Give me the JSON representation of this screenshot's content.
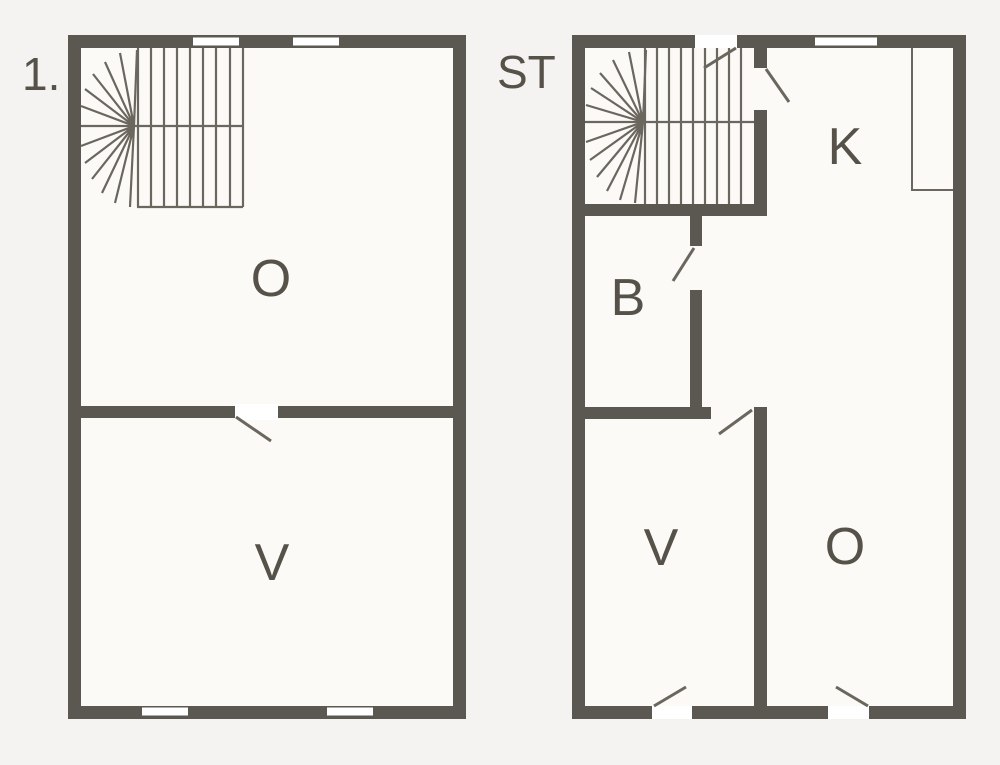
{
  "colors": {
    "background": "#f4f3f1",
    "floor": "#fbfaf7",
    "window": "#ffffff",
    "wall": "#5b5852",
    "line": "#6b675f",
    "text": "#56524a"
  },
  "plans": [
    {
      "label": "1.",
      "rooms": [
        {
          "name": "O"
        },
        {
          "name": "V"
        }
      ]
    },
    {
      "label": "ST",
      "rooms": [
        {
          "name": "K"
        },
        {
          "name": "B"
        },
        {
          "name": "V"
        },
        {
          "name": "O"
        }
      ]
    }
  ]
}
